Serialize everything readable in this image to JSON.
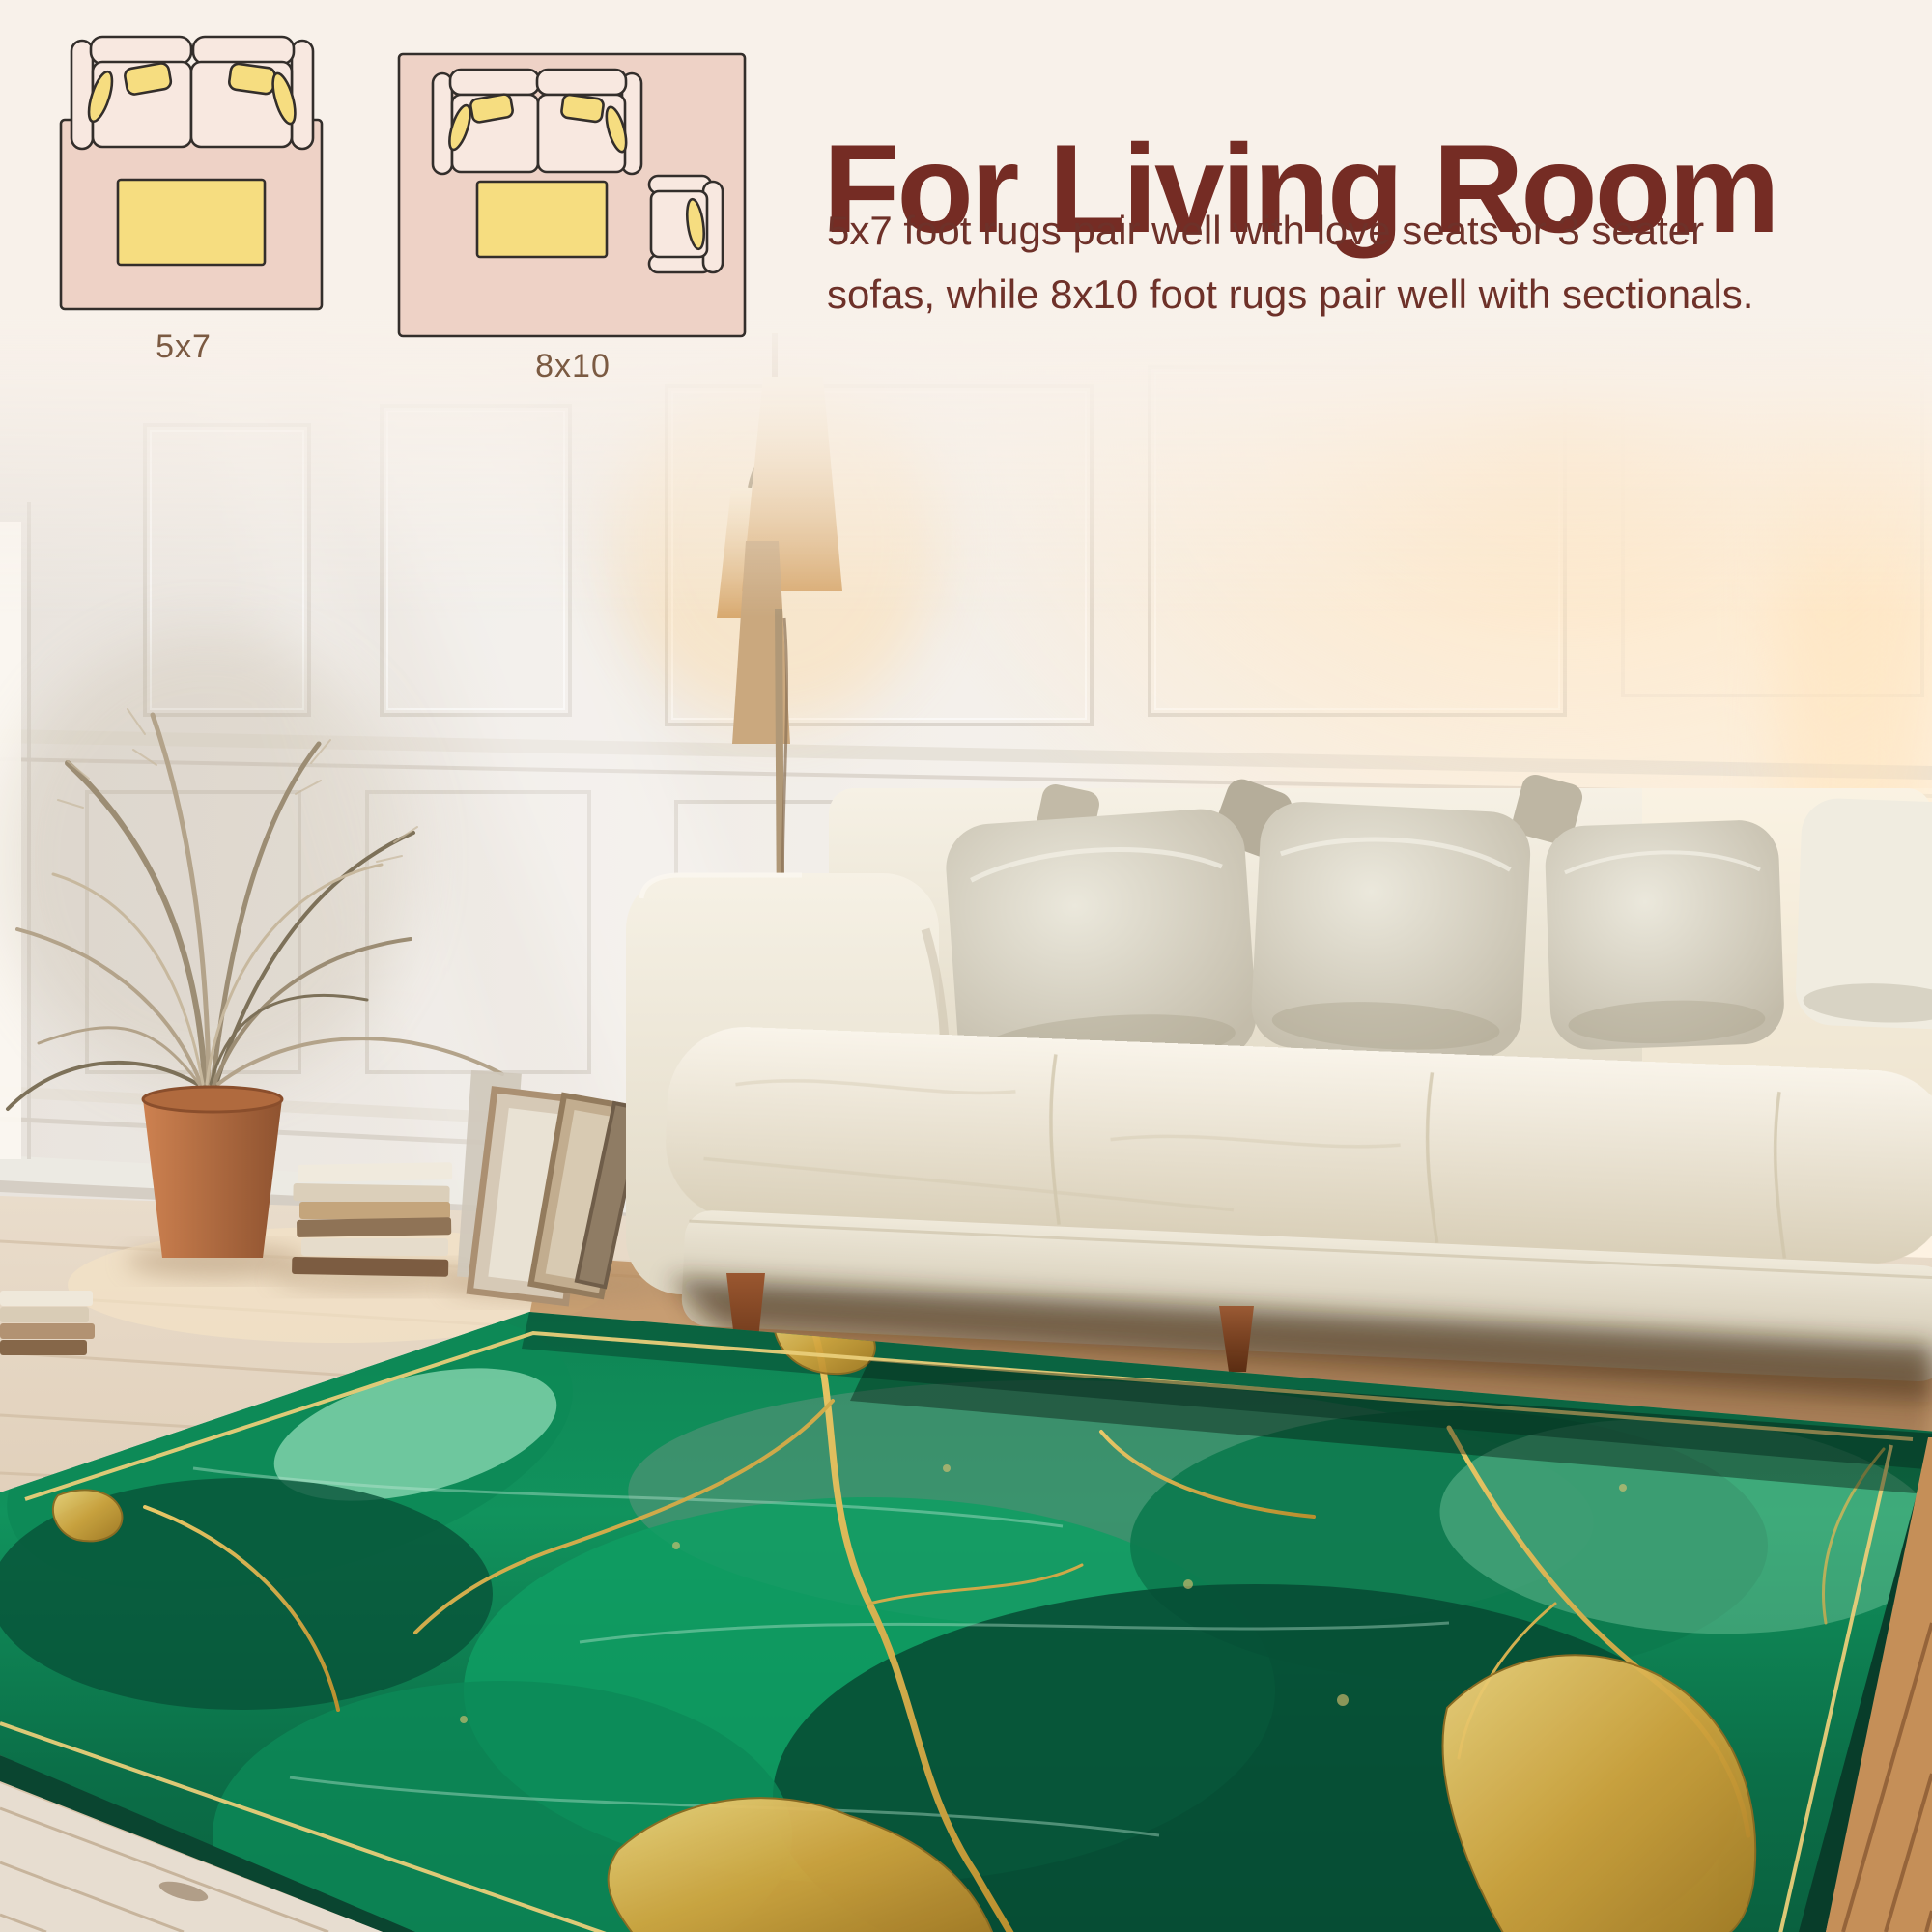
{
  "header": {
    "title": "For Living Room",
    "description_lines": [
      "5x7 foot rugs pair well with love seats or 3 seater",
      "sofas, while 8x10 foot rugs pair well with sectionals."
    ]
  },
  "size_guide": {
    "items": [
      {
        "label": "5x7",
        "furniture": [
          "sofa-top-view",
          "coffee-table"
        ]
      },
      {
        "label": "8x10",
        "furniture": [
          "sofa-top-view",
          "coffee-table",
          "armchair"
        ]
      }
    ]
  },
  "photo": {
    "objects": [
      "paneled-wall",
      "floor-lamp",
      "dried-palm-plant",
      "terracotta-pot",
      "stacked-books",
      "leaning-frames",
      "white-sofa",
      "throw-pillows",
      "wood-floor",
      "green-gold-marble-rug"
    ]
  },
  "colors": {
    "background_cream": "#f8f1ea",
    "title_maroon": "#752c24",
    "body_maroon": "#6e3129",
    "label_brown": "#7b5a42",
    "diagram_rug_pink": "#eed2c6",
    "diagram_sofa_fill": "#f8e8e0",
    "diagram_accent_yellow": "#f6dd80",
    "diagram_outline": "#332e2b",
    "rug_emerald": "#0f8f5c",
    "rug_gold": "#d7b558"
  }
}
